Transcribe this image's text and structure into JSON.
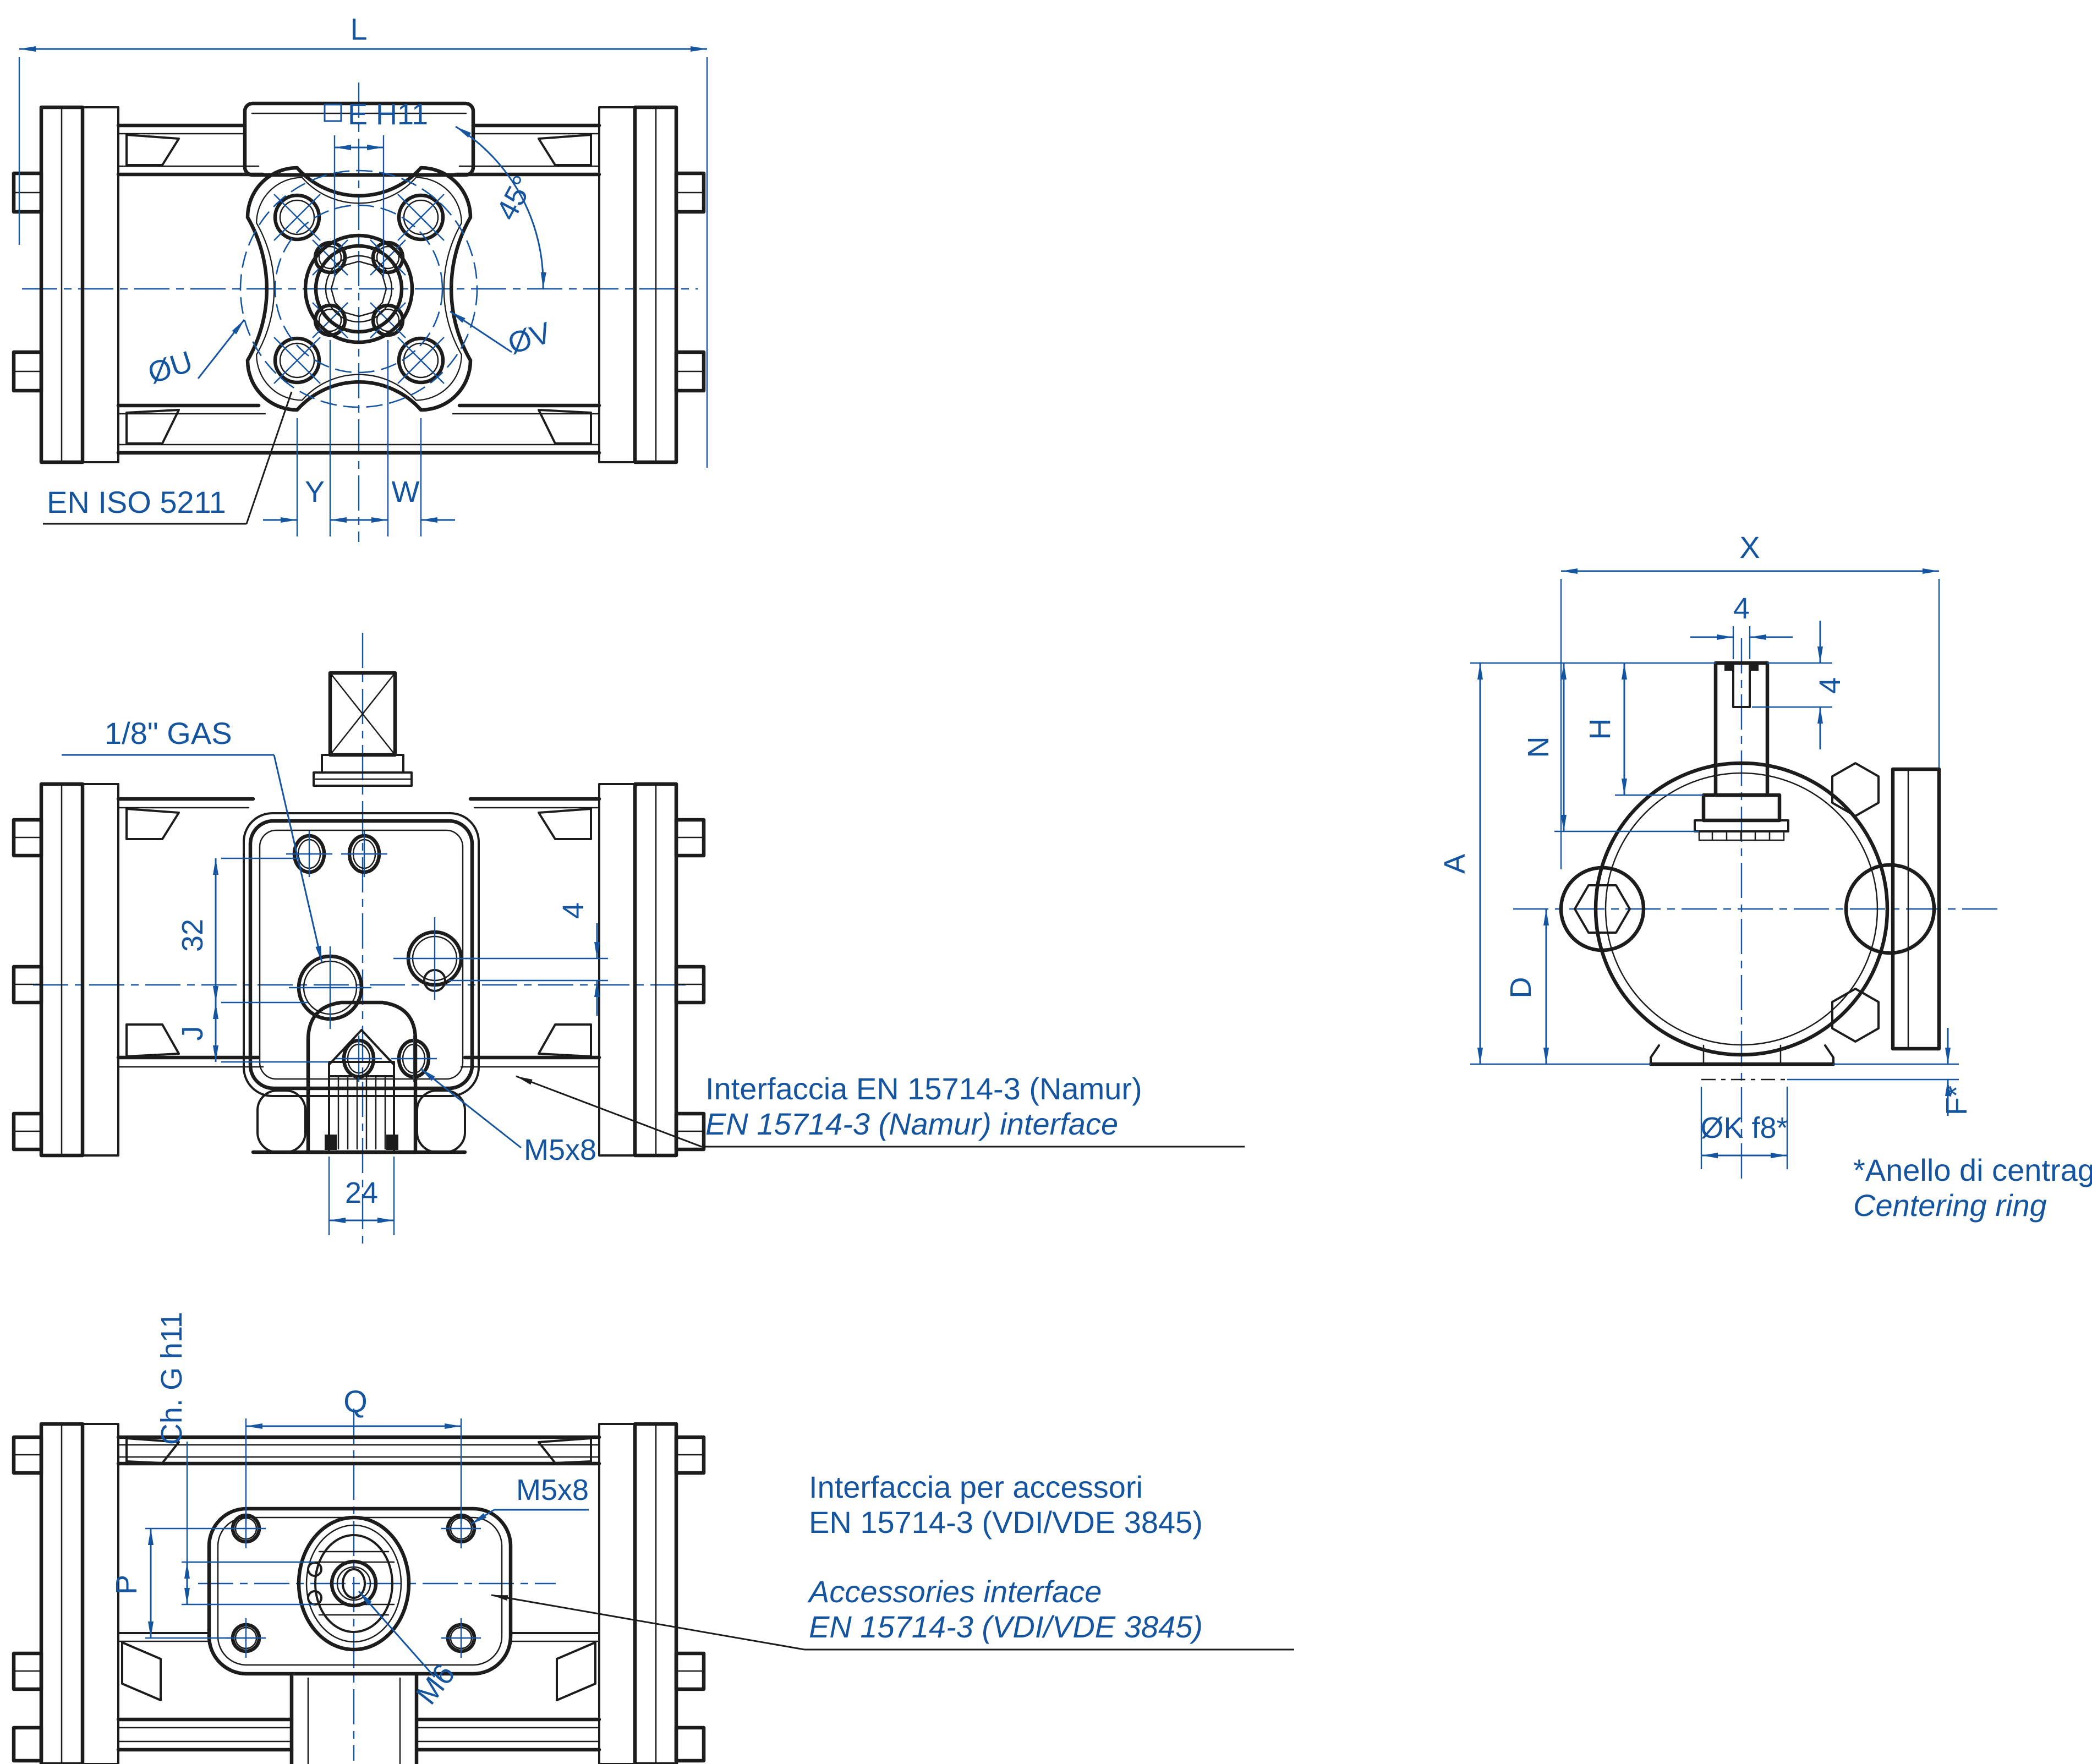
{
  "colors": {
    "annotation": "#15549E",
    "line": "#1c1c1c"
  },
  "front_view": {
    "l_label": "L",
    "e_label": "E H11",
    "angle_label": "45°",
    "du_label": "ØU",
    "dv_label": "ØV",
    "y_label": "Y",
    "w_label": "W",
    "iso_label": "EN ISO 5211"
  },
  "top_view": {
    "gas_label": "1/8\" GAS",
    "dim_32": "32",
    "dim_4": "4",
    "j_label": "J",
    "dim_24": "24",
    "m5x8_label": "M5x8",
    "note_line1": "Interfaccia EN 15714-3 (Namur)",
    "note_line2": "EN 15714-3 (Namur) interface"
  },
  "side_view": {
    "x_label": "X",
    "slot_width": "4",
    "slot_depth": "4",
    "h_label": "H",
    "n_label": "N",
    "a_label": "A",
    "d_label": "D",
    "k_label": "ØK f8*",
    "f_label": "F*",
    "footnote_line1": "*Anello di centraggio",
    "footnote_line2": "Centering ring"
  },
  "bottom_view": {
    "ch_label": "Ch. G h11",
    "q_label": "Q",
    "m5x8_label": "M5x8",
    "p_label": "P",
    "m6_label": "M6",
    "note_line1": "Interfaccia per accessori",
    "note_line2": "EN 15714-3 (VDI/VDE 3845)",
    "note_line3": "Accessories interface",
    "note_line4": "EN 15714-3 (VDI/VDE 3845)"
  }
}
